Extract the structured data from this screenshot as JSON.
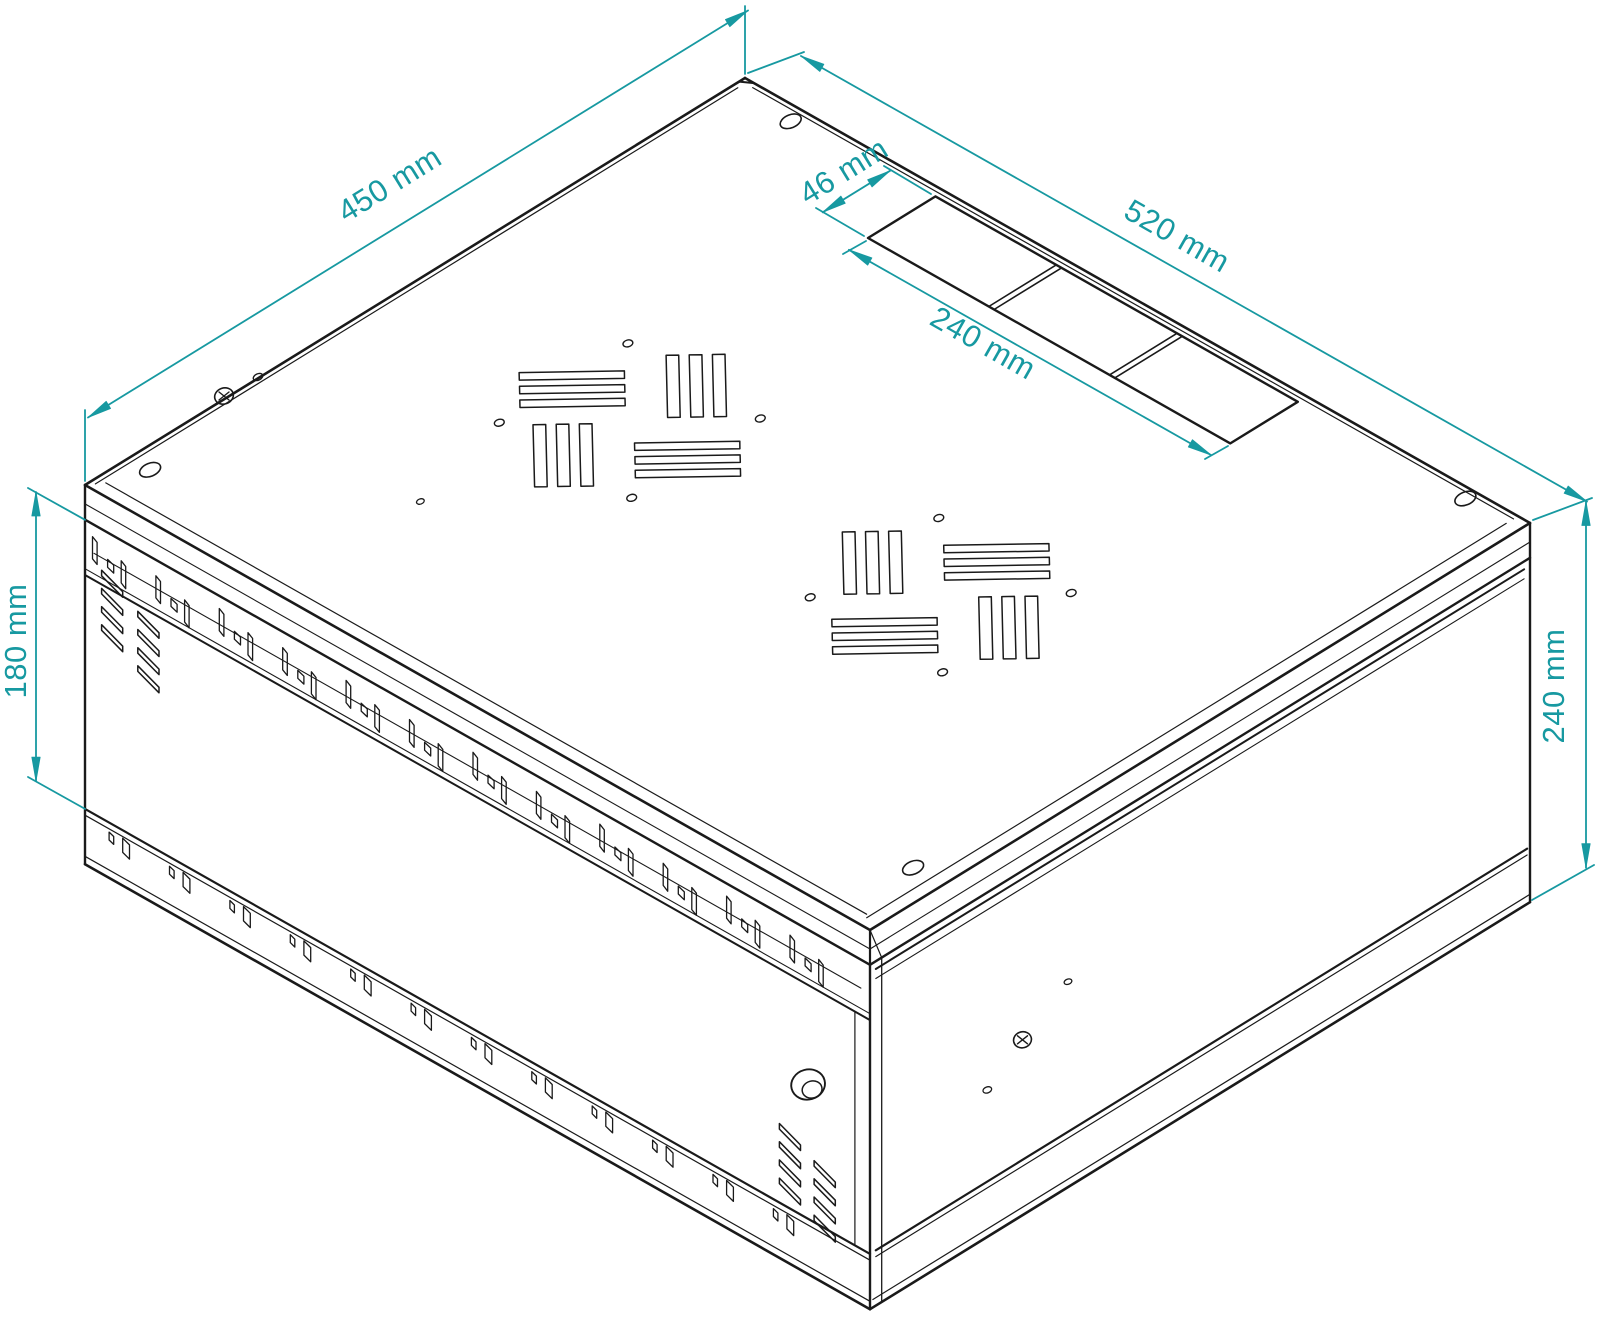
{
  "page": {
    "title": "Rack cabinet isometric dimension drawing",
    "background": "#ffffff"
  },
  "colors": {
    "line": "#1a1a1a",
    "dimension": "#1799a1",
    "background": "#ffffff"
  },
  "drawing": {
    "subject": "wall-mounted rack cabinet shown in isometric view",
    "style": "monochrome technical line drawing with teal dimension annotations",
    "features": [
      "top panel with two pinwheel fan vent cutouts",
      "rear cable-entry strip with three knockout panels",
      "front door with cylinder lock and louver vents",
      "ventilation slot rows on front rails",
      "corner mounting holes on top panel"
    ]
  },
  "dimensions": {
    "top_left_edge": {
      "label": "450 mm",
      "value_mm": 450,
      "measures": "cabinet depth along top-left edge"
    },
    "top_right_edge": {
      "label": "520 mm",
      "value_mm": 520,
      "measures": "cabinet width along top-right edge"
    },
    "cable_knockout_width": {
      "label": "46 mm",
      "value_mm": 46,
      "measures": "cable-entry knockout strip width"
    },
    "cable_knockout_length": {
      "label": "240 mm",
      "value_mm": 240,
      "measures": "cable-entry knockout strip length"
    },
    "front_panel_height": {
      "label": "180 mm",
      "value_mm": 180,
      "measures": "front door panel height"
    },
    "side_height": {
      "label": "240 mm",
      "value_mm": 240,
      "measures": "overall cabinet height at right side"
    }
  }
}
